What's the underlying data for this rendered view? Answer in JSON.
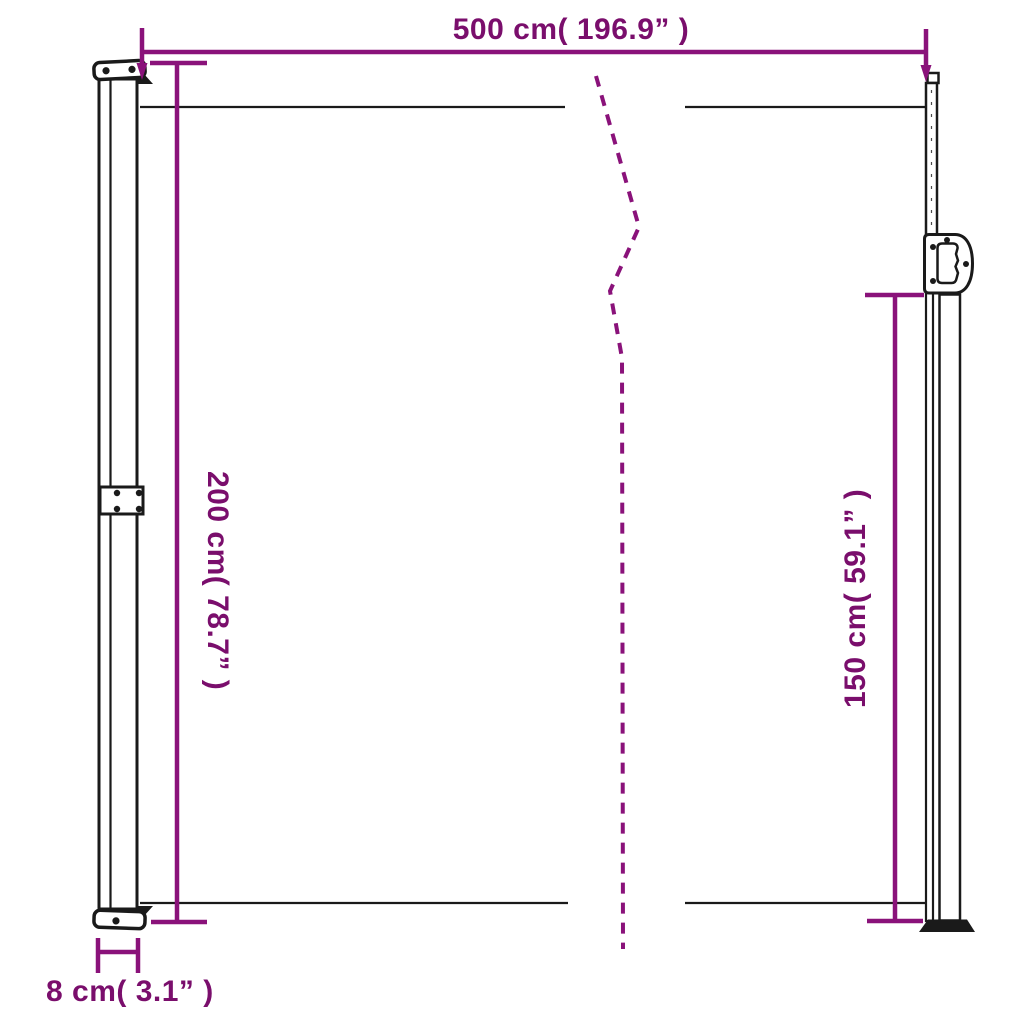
{
  "diagram": {
    "kind": "product-dimension-diagram",
    "subject": "retractable-side-awning",
    "colors": {
      "dimension_purple": "#8A127A",
      "label_purple": "#7A0E6C",
      "outline_black": "#1A1A1A",
      "background_white": "#FFFFFF"
    },
    "dimensions": {
      "width": {
        "value_cm": "500",
        "value_in": "196.9",
        "label": "500 cm( 196.9” )"
      },
      "height": {
        "value_cm": "200",
        "value_in": "78.7",
        "label": "200 cm( 78.7” )"
      },
      "pole_height": {
        "value_cm": "150",
        "value_in": "59.1",
        "label": "150 cm( 59.1” )"
      },
      "depth": {
        "value_cm": "8",
        "value_in": "3.1",
        "label": "8 cm( 3.1” )"
      }
    }
  }
}
